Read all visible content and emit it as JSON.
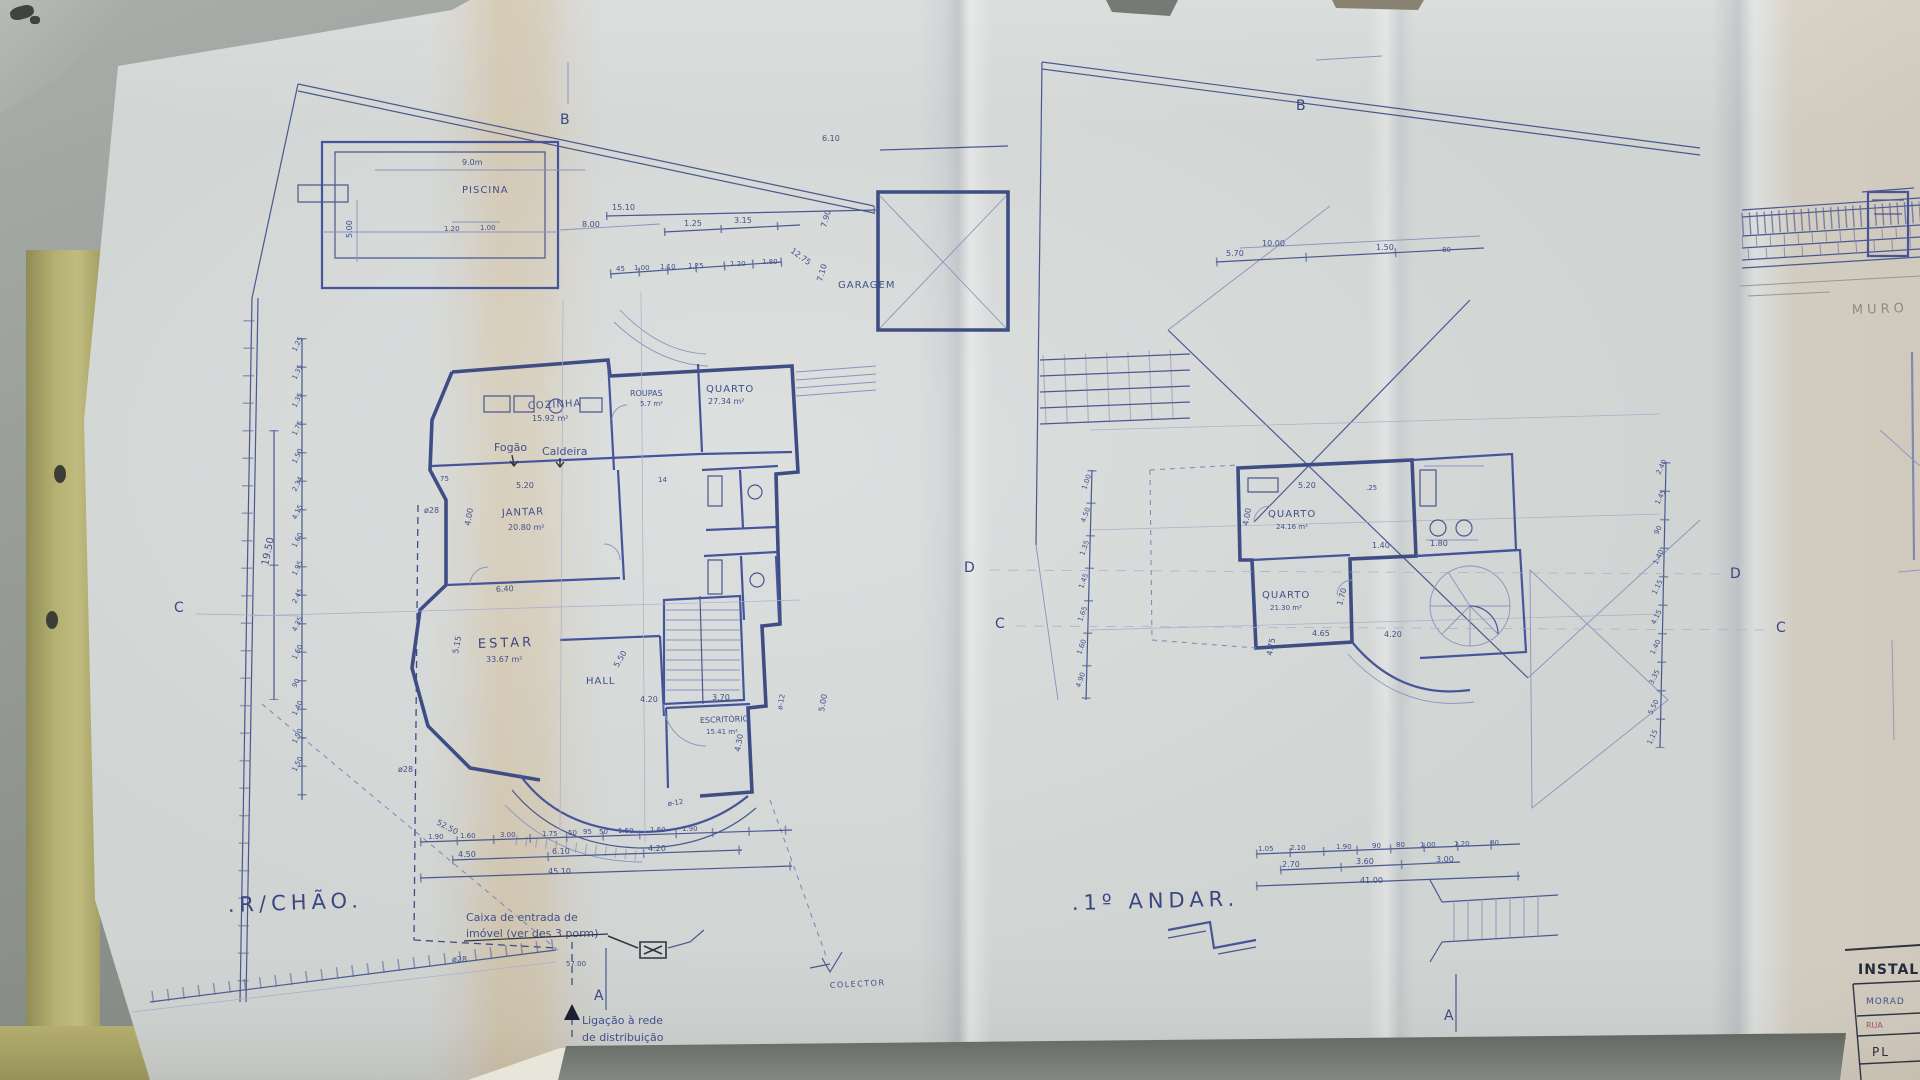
{
  "scene": {
    "colors": {
      "ink": "#42508a",
      "ink_dark": "#3f4d85",
      "ink_faint": "#8a94bd",
      "pencil": "#8f8a80",
      "paper": "#d0d4d3",
      "table": "#878c86",
      "stain": "#cd9e58",
      "folder": "#b5b171"
    },
    "description": "Photo of folded blueprint floor plans on grey table"
  },
  "left_plan": {
    "title": ".R/CHÃO.",
    "pool": {
      "label": "PISCINA",
      "dim_w": "9.0m",
      "dim_h": "5.00",
      "dim_a": "1.20",
      "dim_b": "1.00"
    },
    "garage": {
      "label": "GARAGEM",
      "dim_w": "6.10",
      "diag": "12.75",
      "v1": "7.90",
      "v2": "7.10"
    },
    "boundary": {
      "total": "15.10",
      "seg0": "8.00",
      "seg1": "1.25",
      "seg2": "3.15",
      "row": [
        "45",
        "1.00",
        "1.10",
        "1.25",
        "1.20",
        "1.80"
      ]
    },
    "rooms": {
      "kitchen": {
        "name": "COZINHA",
        "area": "15.92 m²"
      },
      "linen": {
        "name": "ROUPAS",
        "area": "5.7 m²"
      },
      "bedroom": {
        "name": "QUARTO",
        "area": "27.34 m²"
      },
      "dining": {
        "name": "JANTAR",
        "area": "20.80 m²"
      },
      "living": {
        "name": "ESTAR",
        "area": "33.67 m²"
      },
      "hall": {
        "name": "HALL"
      },
      "office": {
        "name": "ESCRITÓRIO",
        "area": "15.41 m²"
      }
    },
    "fixtures": {
      "stove": "Fogão",
      "boiler": "Caldeira"
    },
    "pipes": {
      "p28": "ø28",
      "p12": "ø-12"
    },
    "inner_dims": {
      "d520": "5.20",
      "d75": "75",
      "d14": "14",
      "d400": "4.00",
      "d640": "6.40",
      "d515": "5.15",
      "d550": "5.50",
      "d420": "4.20",
      "d370": "3.70",
      "d500": "5.00",
      "d430": "4.30"
    },
    "left_chain": [
      "1.25",
      "1.35",
      "1.35",
      "1.75",
      "1.50",
      "2.34",
      "4.15",
      "1.60",
      "1.95",
      "2.45",
      "4.35",
      "1.60",
      "90",
      "1.40",
      "1.90",
      "1.50"
    ],
    "left_chain_total": "19.50",
    "diag_dim": "52.50",
    "bottom": {
      "row1": [
        "1.90",
        "1.60",
        "3.00",
        "1.75",
        "50",
        "95",
        "50",
        "1.50",
        "1.60",
        "1.90"
      ],
      "row2": [
        "4.50",
        "6.10",
        "4.20"
      ],
      "total": "45.10"
    },
    "notes": {
      "entry1": "Caixa de entrada de",
      "entry2": "imóvel (ver des 3 porm)",
      "lig1": "Ligação à rede",
      "lig2": "de distribuição",
      "collector": "COLECTOR",
      "d5700": "57.00"
    },
    "sections": {
      "b": "B",
      "c": "C",
      "d": "D",
      "a": "A"
    }
  },
  "right_plan": {
    "title": ".1º ANDAR.",
    "top_dims": [
      "5.70",
      "10.00",
      "1.50",
      "80"
    ],
    "rooms": {
      "bedroom1": {
        "name": "QUARTO",
        "area": "24.16 m²"
      },
      "bedroom2": {
        "name": "QUARTO",
        "area": "21.30 m²"
      }
    },
    "inner_dims": {
      "d520": "5.20",
      "d25": ".25",
      "d400": "4.00",
      "d140": "1.40",
      "d180": "1.80",
      "d170": "1.70",
      "d465": "4.65",
      "d420": "4.20",
      "d475": "4.75"
    },
    "left_chain": [
      "1.00",
      "4.50",
      "1.35",
      "1.45",
      "1.65",
      "1.60",
      "4.90"
    ],
    "right_chain": [
      "2.40",
      "1.45",
      "90",
      "1.40",
      "1.15",
      "4.15",
      "1.40",
      "3.35",
      "5.50",
      "1.15"
    ],
    "bottom": {
      "row1": [
        "1.05",
        "2.10",
        "1.90",
        "90",
        "80",
        "1.00",
        "1.20",
        "80"
      ],
      "row2": [
        "2.70",
        "3.60",
        "3.00"
      ],
      "total": "41.00"
    },
    "sections": {
      "b": "B",
      "c": "C",
      "d": "D",
      "a": "A"
    }
  },
  "side_panel": {
    "muro": "MURO",
    "title_block": {
      "header": "INSTAL",
      "line1": "MORAD",
      "line2": "RUA",
      "line3": "PL"
    }
  }
}
